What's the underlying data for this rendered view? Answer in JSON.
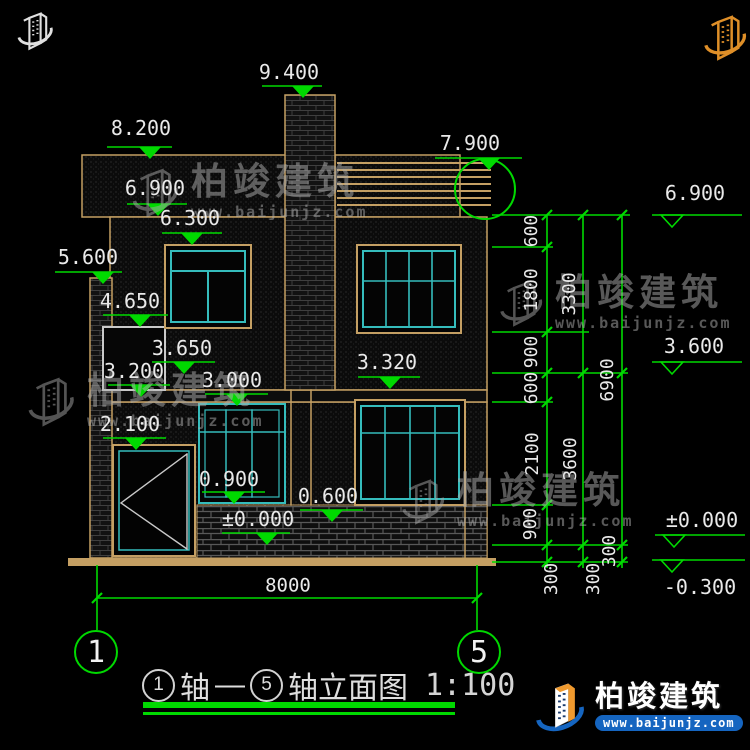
{
  "title": {
    "axis_a": "1",
    "axis_word_a": "轴",
    "dash": "—",
    "axis_b": "5",
    "axis_word_b": "轴立面图",
    "scale": "1:100"
  },
  "axes": {
    "left": "1",
    "right": "5"
  },
  "levels_left": {
    "v9400": "9.400",
    "v8200": "8.200",
    "v7900": "7.900",
    "v6900": "6.900",
    "v6300": "6.300",
    "v5600": "5.600",
    "v4650": "4.650",
    "v3650": "3.650",
    "v3320": "3.320",
    "v3200": "3.200",
    "v3000": "3.000",
    "v2100": "2.100",
    "v0900": "0.900",
    "v0600": "0.600",
    "v0000": "±0.000"
  },
  "levels_right": {
    "v6900": "6.900",
    "v3600": "3.600",
    "v0000": "±0.000",
    "vm0300": "-0.300"
  },
  "dims": {
    "total": "8000",
    "chain_inner": [
      "600",
      "1800",
      "900",
      "600",
      "2100",
      "900",
      "300"
    ],
    "chain_mid": [
      "3300",
      "3600",
      "300"
    ],
    "chain_outer": [
      "6900",
      "300"
    ]
  },
  "brand": {
    "name": "柏竣建筑",
    "url": "www.baijunjz.com"
  },
  "colors": {
    "dim_green": "#00d900",
    "outline_tan": "#c49f63",
    "window_cyan": "#35bcbc",
    "logo_blue": "#1565c0",
    "logo_orange": "#f09a2e",
    "background": "#000000"
  }
}
